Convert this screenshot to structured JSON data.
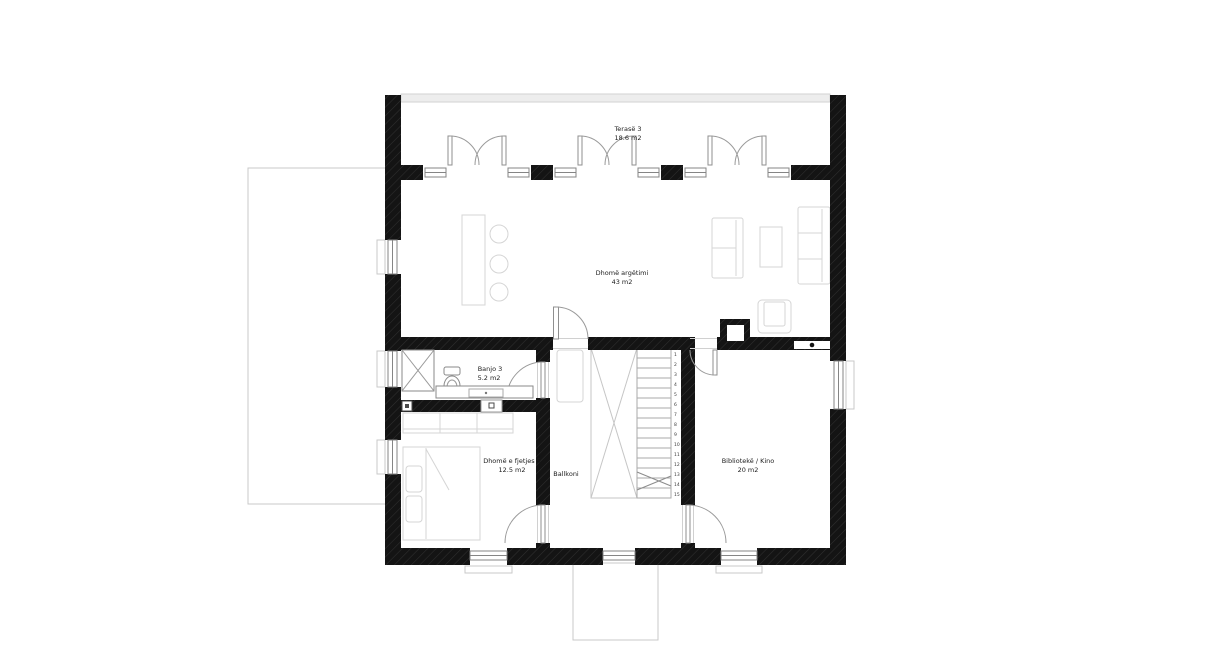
{
  "plan": {
    "title": "Floor plan",
    "rooms": [
      {
        "id": "terrace",
        "name": "Terasë 3",
        "area": "18.6 m2"
      },
      {
        "id": "living",
        "name": "Dhomë argëtimi",
        "area": "43 m2"
      },
      {
        "id": "bath",
        "name": "Banjo 3",
        "area": "5.2 m2"
      },
      {
        "id": "bedroom",
        "name": "Dhomë e fjetjes 5",
        "area": "12.5 m2"
      },
      {
        "id": "balcony",
        "name": "Ballkoni",
        "area": ""
      },
      {
        "id": "library",
        "name": "Bibliotekë / Kino",
        "area": "20 m2"
      }
    ],
    "stairs": {
      "steps": [
        "1",
        "2",
        "3",
        "4",
        "5",
        "6",
        "7",
        "8",
        "9",
        "10",
        "11",
        "12",
        "13",
        "14",
        "15"
      ]
    },
    "colors": {
      "wall": "#141414",
      "wall_hatch": "#2f2f2f",
      "outline_gray": "#c9c9c9",
      "furniture_gray": "#d5d5d5",
      "fixture_gray": "#8a8a8a",
      "text": "#1c1c1c",
      "background": "#ffffff"
    }
  }
}
